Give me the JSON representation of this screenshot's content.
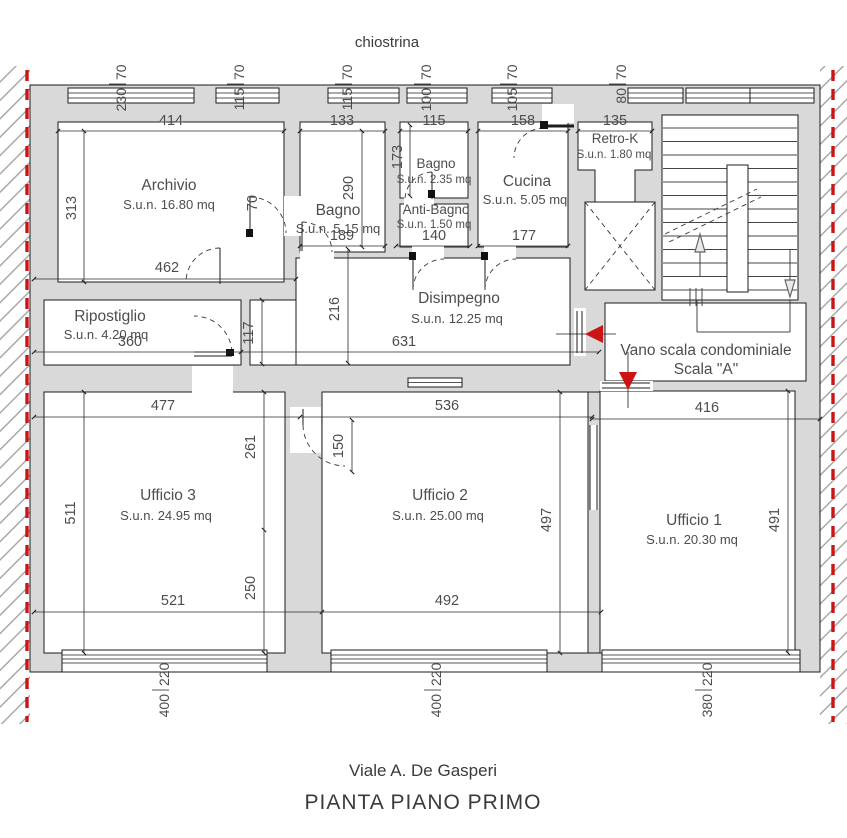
{
  "header": {
    "courtyard_label": "chiostrina"
  },
  "footer": {
    "street": "Viale A. De Gasperi",
    "title": "PIANTA PIANO PRIMO"
  },
  "rooms": {
    "archivio": {
      "name": "Archivio",
      "area": "S.u.n. 16.80 mq"
    },
    "bagno1": {
      "name": "Bagno",
      "area": "S.u.n. 5.15 mq"
    },
    "bagno2": {
      "name": "Bagno",
      "area": "S.u.n. 2.35 mq"
    },
    "antibagno": {
      "name": "Anti-Bagno",
      "area": "S.u.n. 1.50 mq"
    },
    "cucina": {
      "name": "Cucina",
      "area": "S.u.n. 5.05 mq"
    },
    "retrok": {
      "name": "Retro-K",
      "area": "S.u.n. 1.80 mq"
    },
    "disimpegno": {
      "name": "Disimpegno",
      "area": "S.u.n. 12.25 mq"
    },
    "ripostiglio": {
      "name": "Ripostiglio",
      "area": "S.u.n. 4.20 mq"
    },
    "ufficio1": {
      "name": "Ufficio 1",
      "area": "S.u.n. 20.30 mq"
    },
    "ufficio2": {
      "name": "Ufficio 2",
      "area": "S.u.n. 25.00 mq"
    },
    "ufficio3": {
      "name": "Ufficio 3",
      "area": "S.u.n. 24.95 mq"
    },
    "vano_scala": {
      "line1": "Vano scala condominiale",
      "line2": "Scala \"A\""
    }
  },
  "dims": {
    "d414": "414",
    "d313": "313",
    "d462": "462",
    "d133": "133",
    "d115": "115",
    "d158": "158",
    "d135": "135",
    "d173": "173",
    "d290": "290",
    "d70": "70",
    "d189": "189",
    "d140": "140",
    "d177": "177",
    "d216": "216",
    "d117": "117",
    "d360": "360",
    "d631": "631",
    "d477": "477",
    "d536": "536",
    "d416": "416",
    "d511": "511",
    "d261": "261",
    "d250": "250",
    "d150": "150",
    "d497": "497",
    "d491": "491",
    "d521": "521",
    "d492": "492"
  },
  "windows": {
    "top": [
      {
        "w": "230",
        "h": "70"
      },
      {
        "w": "115",
        "h": "70"
      },
      {
        "w": "115",
        "h": "70"
      },
      {
        "w": "100",
        "h": "70"
      },
      {
        "w": "105",
        "h": "70"
      },
      {
        "w": "80",
        "h": "70"
      }
    ],
    "bottom": [
      {
        "w": "400",
        "h": "220"
      },
      {
        "w": "400",
        "h": "220"
      },
      {
        "w": "380",
        "h": "220"
      }
    ]
  },
  "colors": {
    "wall": "#d9d9d9",
    "line": "#1c1c1c",
    "text": "#4d4d4d",
    "red": "#cc1414",
    "hatch": "#9b9b9b"
  }
}
